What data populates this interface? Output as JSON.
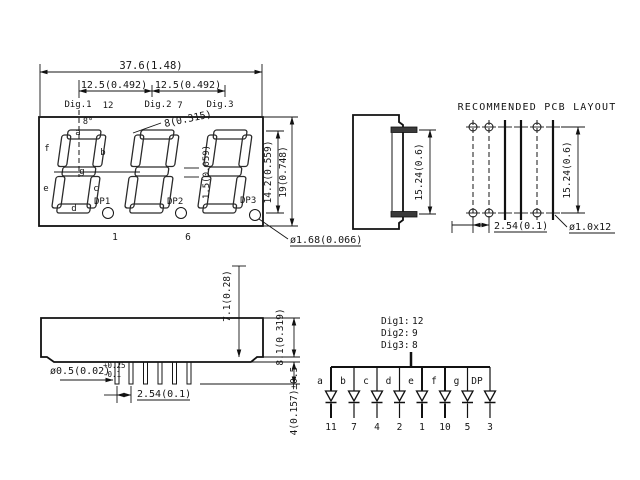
{
  "front_view": {
    "dim_overall_width": "37.6(1.48)",
    "dim_pitch_left": "12.5(0.492)",
    "dim_pitch_right": "12.5(0.492)",
    "digit1_label": "Dig.1",
    "digit1_pin": "12",
    "digit2_label": "Dig.2",
    "digit2_pin": "7",
    "digit3_label": "Dig.3",
    "slant_angle": "8°",
    "dim_char_width": "8(0.315)",
    "dim_seg_gap": "1.5(0.059)",
    "seg_a": "a",
    "seg_b": "b",
    "seg_c": "c",
    "seg_d": "d",
    "seg_e": "e",
    "seg_f": "f",
    "seg_g": "g",
    "dp1": "DP1",
    "dp2": "DP2",
    "dp3": "DP3",
    "pin1": "1",
    "pin6": "6",
    "dim_char_height": "14.2(0.559)",
    "dim_body_height": "19(0.748)",
    "dim_dp_diameter": "ø1.68(0.066)"
  },
  "side_view": {
    "dim_pin_row_spacing": "15.24(0.6)"
  },
  "pcb_layout": {
    "title": "RECOMMENDED PCB LAYOUT",
    "dim_hole_pitch": "2.54(0.1)",
    "dim_row_spacing": "15.24(0.6)",
    "hole_spec": "ø1.0x12"
  },
  "bottom_view": {
    "dim_standoff": "7.1(0.28)",
    "dim_body_thickness": "8.1(0.319)",
    "dim_pin_diameter": "ø0.5(0.02)",
    "tol_plus": "+0.25",
    "tol_minus": "-0.1",
    "dim_pin_pitch": "2.54(0.1)",
    "dim_pin_length": "4(0.157)±0.5"
  },
  "schematic": {
    "digits": [
      {
        "label": "Dig1:",
        "pin": "12"
      },
      {
        "label": "Dig2:",
        "pin": "9"
      },
      {
        "label": "Dig3:",
        "pin": "8"
      }
    ],
    "segments": [
      {
        "label": "a",
        "pin": "11"
      },
      {
        "label": "b",
        "pin": "7"
      },
      {
        "label": "c",
        "pin": "4"
      },
      {
        "label": "d",
        "pin": "2"
      },
      {
        "label": "e",
        "pin": "1"
      },
      {
        "label": "f",
        "pin": "10"
      },
      {
        "label": "g",
        "pin": "5"
      },
      {
        "label": "DP",
        "pin": "3"
      }
    ]
  }
}
